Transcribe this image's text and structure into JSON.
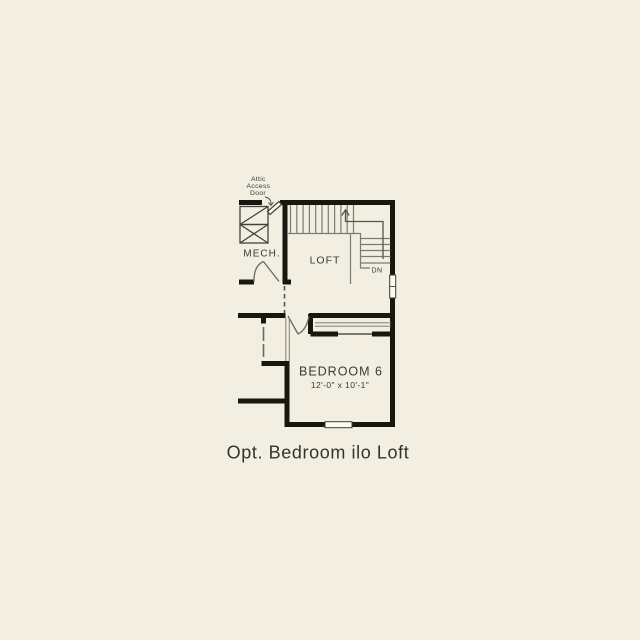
{
  "title": "Opt. Bedroom ilo Loft",
  "colors": {
    "background": "#f2efe2",
    "wall_ink": "#18170f",
    "thin_line": "#7c7b70",
    "text": "#3b3a30",
    "window_fill": "#fdfcf4"
  },
  "labels": {
    "attic": [
      "Attic",
      "Access",
      "Door"
    ],
    "mech": "MECH.",
    "loft": "LOFT",
    "dn": "DN",
    "bedroom": "BEDROOM 6",
    "bedroom_dims": "12'-0\" x 10'-1\"",
    "caption": "Opt. Bedroom ilo Loft"
  },
  "rooms": [
    {
      "name": "MECH.",
      "dims": ""
    },
    {
      "name": "LOFT",
      "dims": ""
    },
    {
      "name": "BEDROOM 6",
      "dims": "12'-0\" x 10'-1\""
    }
  ]
}
